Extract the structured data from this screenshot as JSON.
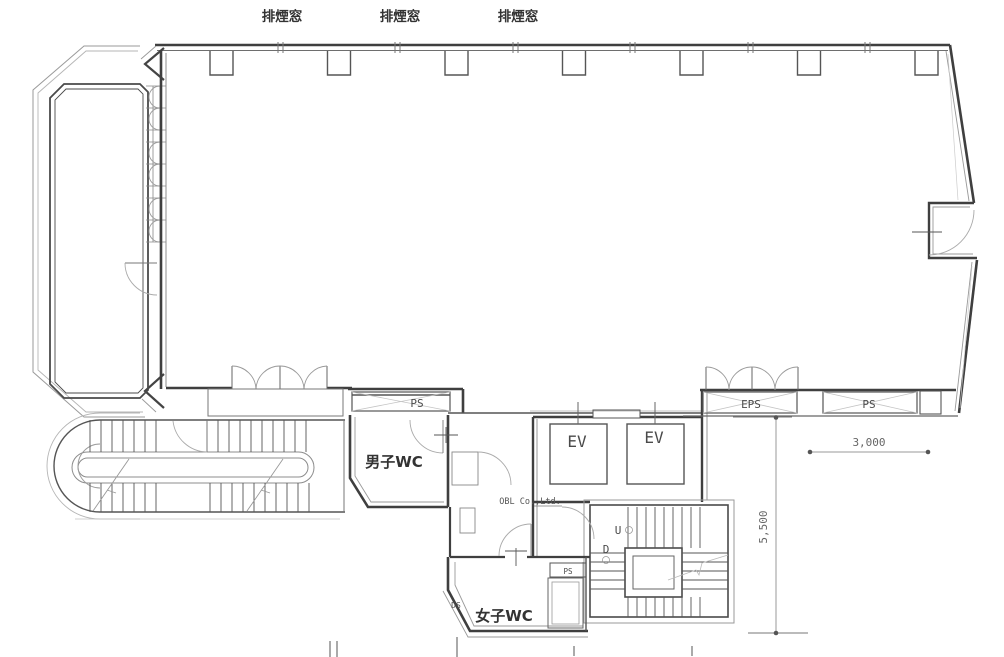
{
  "drawing": {
    "type": "architectural floor plan",
    "company": "OBL Co.,Ltd."
  },
  "labels": {
    "smoke_windows": [
      "排煙窓",
      "排煙窓",
      "排煙窓"
    ],
    "ps_left": "PS",
    "mens_wc": "男子WC",
    "womens_wc": "女子WC",
    "ev_1": "EV",
    "ev_2": "EV",
    "eps": "EPS",
    "ps_right": "PS",
    "ps_small": "PS",
    "ds": "DS",
    "stair_up": "U",
    "stair_down": "D"
  },
  "dimensions": {
    "horizontal": "3,000",
    "vertical": "5,500"
  },
  "watermark": "OBL Co.,Ltd.",
  "colors": {
    "wall": "#3f3f3f",
    "thin_line": "#8c8c8c",
    "light_line": "#bdbdbd",
    "text": "#333333",
    "background": "#ffffff"
  }
}
